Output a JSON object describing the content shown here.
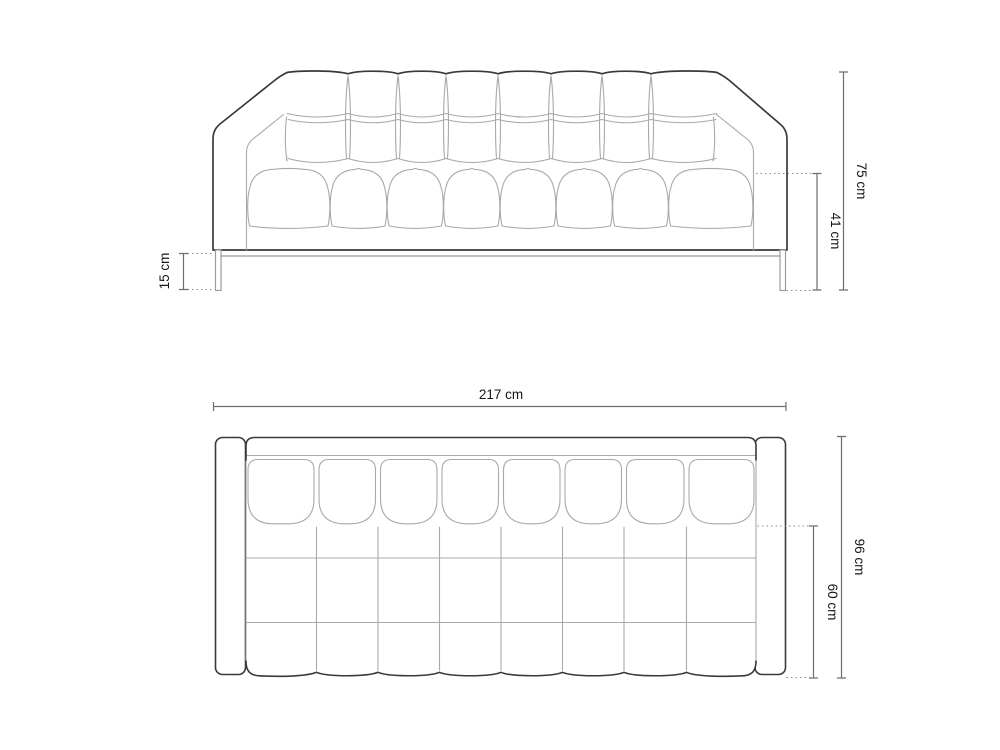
{
  "diagram": {
    "product": "sofa technical dimension drawing",
    "views": {
      "front": {
        "name": "front elevation",
        "dimensions": {
          "overall_height": "75 cm",
          "seat_height": "41 cm",
          "leg_height": "15 cm"
        }
      },
      "top": {
        "name": "top plan",
        "dimensions": {
          "overall_width": "217 cm",
          "overall_depth": "96 cm",
          "seat_depth": "60 cm"
        }
      }
    }
  },
  "colors": {
    "background": "#ffffff",
    "outline": "#3a3a3a",
    "detail_line": "#a9a9a9",
    "dimension_line": "#6e6e6e",
    "dotted_line": "#8a8a8a",
    "text": "#161616"
  }
}
